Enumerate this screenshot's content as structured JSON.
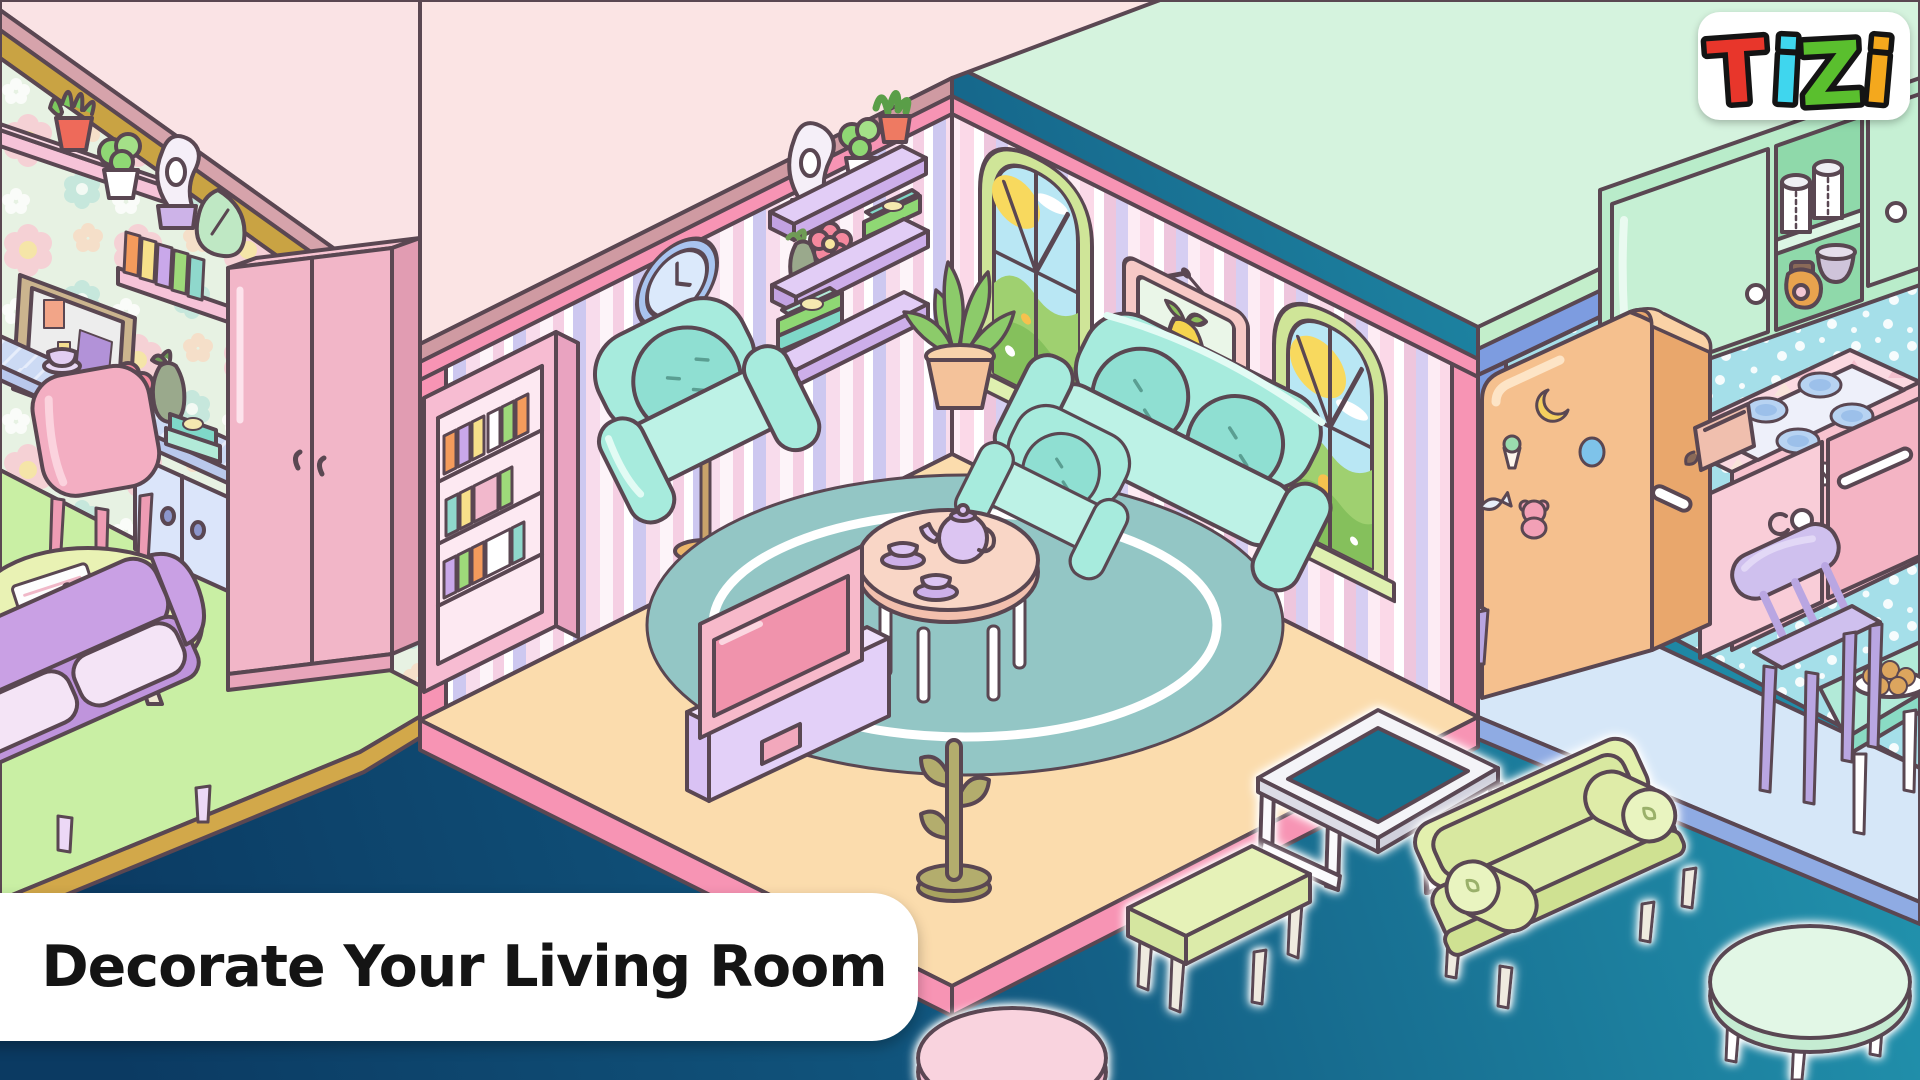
{
  "app": {
    "name": "TIZI",
    "screen": "living room decoration promo"
  },
  "logo": {
    "letters": [
      "T",
      "i",
      "Z",
      "i"
    ],
    "colors": [
      "#e8362b",
      "#3fd6ee",
      "#5abf2e",
      "#f4a81d"
    ],
    "outline": "#141414",
    "badge_bg": "#ffffff"
  },
  "banner": {
    "label": "Decorate Your Living Room",
    "bg": "#ffffff",
    "text_color": "#141414"
  },
  "palette": {
    "outline": "#5a4752",
    "background_teal": "#2191ac",
    "background_navy": "#0b3a62",
    "living_ceiling_pink": "#fbe4e4",
    "living_trim_pink": "#f794b4",
    "living_floor_peach": "#fbdcad",
    "stripe_lavender": "#cdc8f0",
    "stripe_pink": "#f5cfe3",
    "kitchen_roof_mint": "#d5f3de",
    "kitchen_trim_blue": "#7d9ce0",
    "kitchen_wall_blue": "#a5dfe9",
    "kitchen_floor_blue": "#d6e7f8",
    "craft_room_floor_green": "#c9efa4",
    "craft_room_beam_gold": "#c9a343",
    "teal_furniture": "#a7ebdd",
    "lavender_furniture": "#cfc0ee",
    "fridge_orange": "#f5c08e"
  },
  "rooms": {
    "left_room": {
      "label": "craft room",
      "wall_style": "floral wallpaper",
      "items": [
        "wall-shelf",
        "aloe-pot",
        "succulent-pot",
        "swan-ornament",
        "triangle-clock",
        "pin-board",
        "book-shelf",
        "desk",
        "teacup",
        "flower-pot",
        "vase",
        "book-stack",
        "desk-cabinet",
        "desk-chair",
        "wardrobe",
        "purple-sofa",
        "oval-table",
        "newspapers"
      ]
    },
    "living_room": {
      "label": "living room",
      "wall_style": "pastel vertical stripes",
      "items": [
        "wall-clock",
        "floating-shelves",
        "swan-ornament",
        "potted-plants",
        "books",
        "flower-pot",
        "arched-window",
        "framed-picture",
        "arched-window",
        "pink-bookcase",
        "floor-lamp",
        "teal-armchair",
        "teal-loveseat",
        "teal-armchair",
        "round-rug",
        "tea-table",
        "tea-set",
        "tv",
        "tv-stand",
        "cactus-coat-rack",
        "potted-plant"
      ]
    },
    "kitchen": {
      "label": "kitchen",
      "wall_style": "dotted blue",
      "items": [
        "upper-cabinets",
        "paper-towel-rolls",
        "jar",
        "bowl",
        "fridge",
        "fridge-stickers",
        "counter",
        "stove-top",
        "toaster",
        "oven",
        "oven-knobs",
        "dining-chair",
        "dining-table",
        "cookie-plate"
      ]
    }
  },
  "draggable_furniture": [
    "metal-coffee-table",
    "green-bench",
    "green-sofa",
    "oval-coffee-table",
    "pink-table"
  ]
}
